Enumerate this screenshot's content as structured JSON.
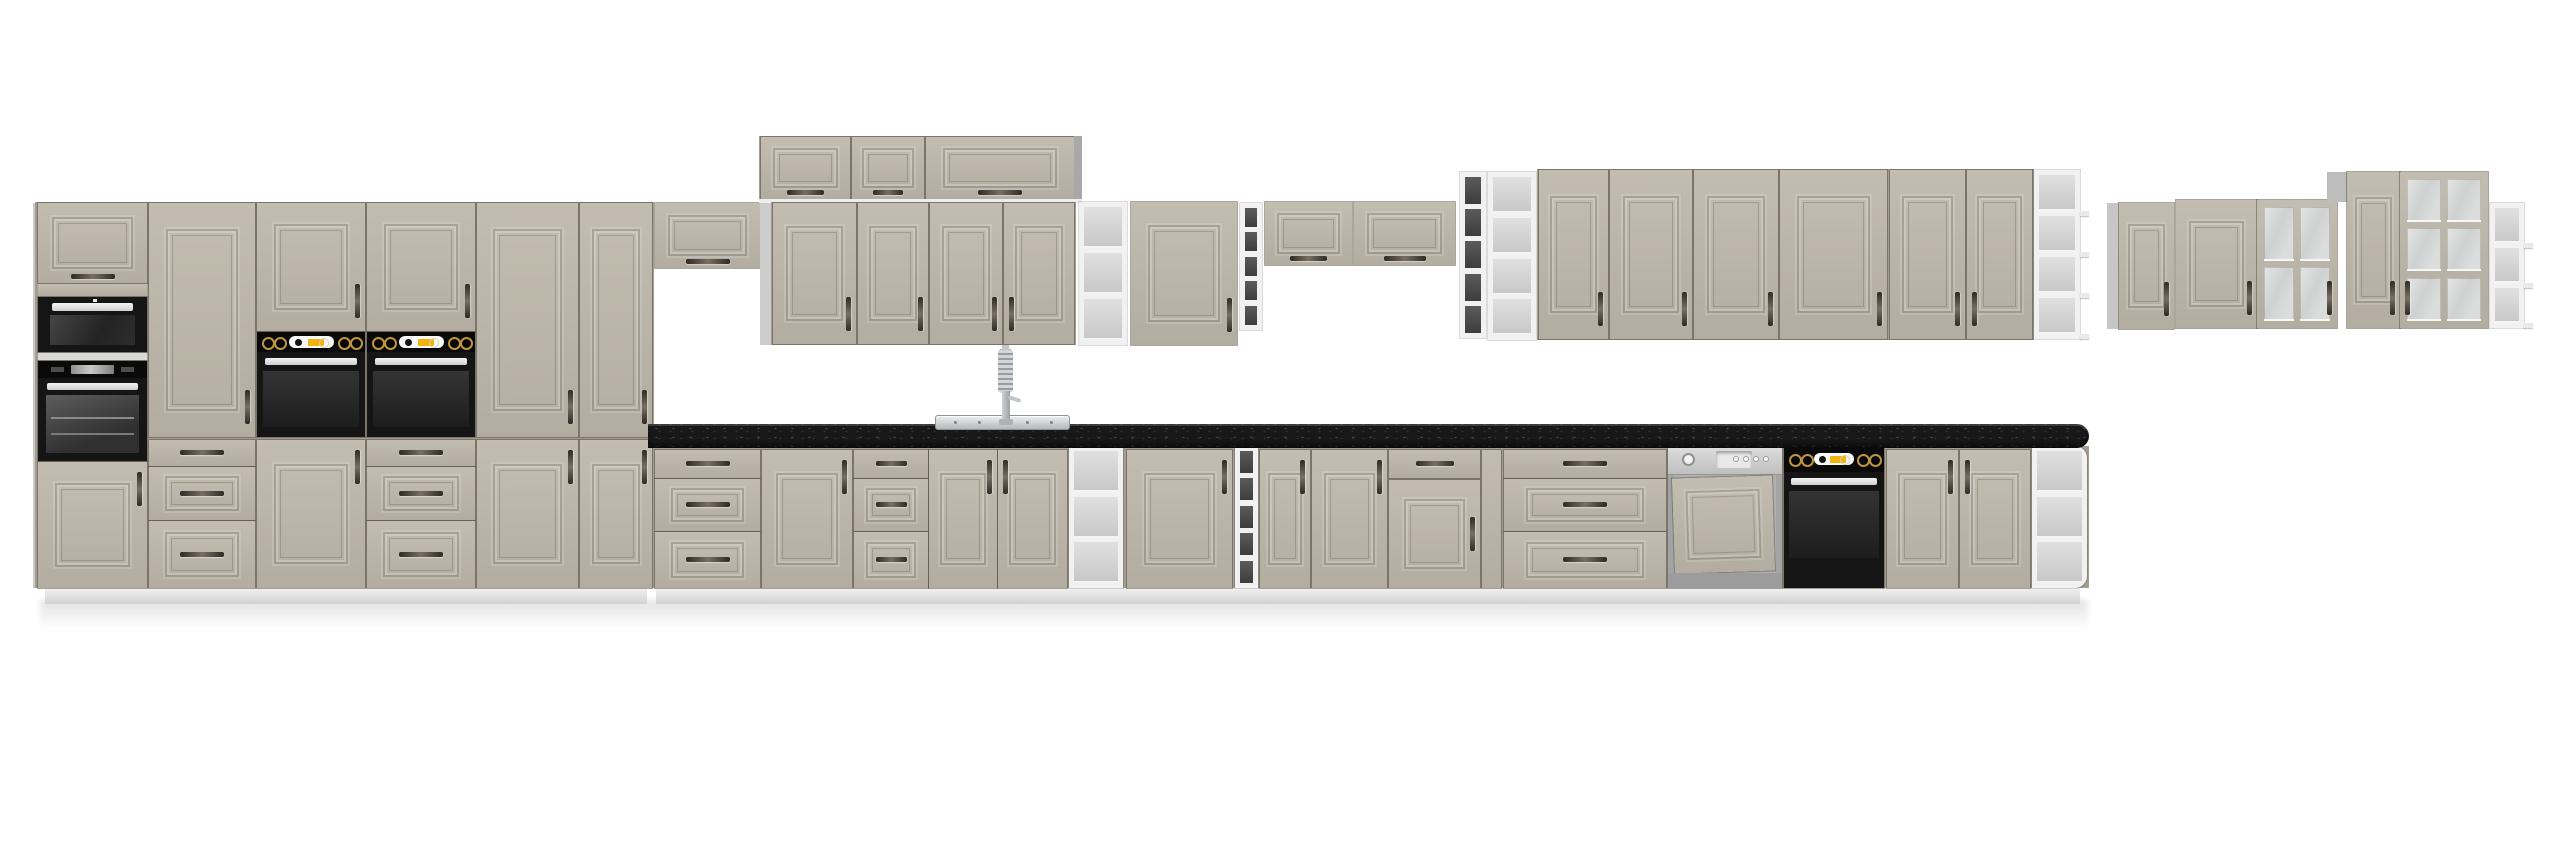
{
  "meta": {
    "domain": "product-render",
    "subject": "kitchen-cabinet-set"
  },
  "palette": {
    "front_beige": "#bcb7aa",
    "front_beige_dark": "#b2ada0",
    "carcass_grey": "#a29d90",
    "side_grey": "#c9c9c9",
    "white_trim": "#ededed",
    "counter_black": "#181818",
    "appliance_black": "#151515",
    "knob_gold": "#bf963f",
    "display_amber": "#f2b40c",
    "stainless": "#cfcfcf",
    "shelf_dark": "#484848",
    "shelf_light": "#d4d4d4",
    "plinth": "#e8e8e8",
    "background": "#ffffff",
    "handle_dark": "#3d3830"
  },
  "canvas": {
    "w": 2560,
    "h": 848
  },
  "scene": {
    "units": [
      {
        "t": "shadow",
        "x": 40,
        "y": 600,
        "w": 2048,
        "h": 30,
        "n": "floor-shadow"
      },
      {
        "t": "panel",
        "x": 33,
        "y": 203,
        "w": 5,
        "h": 385,
        "c": "#c9c9c9",
        "n": "tall-run-left-side"
      },
      {
        "t": "panel",
        "x": 35,
        "y": 202,
        "w": 619,
        "h": 386,
        "c": "#a29d90",
        "n": "tall-run-carcass"
      },
      {
        "t": "plinth",
        "x": 45,
        "y": 588,
        "w": 602,
        "h": 16,
        "n": "plinth"
      },
      {
        "t": "plinth",
        "x": 656,
        "y": 588,
        "w": 1424,
        "h": 16,
        "n": "plinth"
      },
      {
        "t": "panel",
        "x": 648,
        "y": 446,
        "w": 1441,
        "h": 142,
        "c": "#a29d90",
        "n": "base-run-carcass"
      },
      {
        "t": "flip",
        "x": 38,
        "y": 203,
        "w": 109,
        "h": 80,
        "hd": "bc",
        "n": "tall-flip-door"
      },
      {
        "t": "face",
        "x": 38,
        "y": 284,
        "w": 109,
        "h": 12,
        "n": "filler-face"
      },
      {
        "t": "microwave",
        "x": 38,
        "y": 297,
        "w": 109,
        "h": 55,
        "n": "built-in-microwave"
      },
      {
        "t": "panel",
        "x": 38,
        "y": 353,
        "w": 109,
        "h": 7,
        "c": "#d8d8d8",
        "n": "appliance-trim"
      },
      {
        "t": "ovenu1",
        "x": 38,
        "y": 361,
        "w": 109,
        "h": 100,
        "n": "built-in-oven"
      },
      {
        "t": "door",
        "x": 38,
        "y": 462,
        "w": 109,
        "h": 126,
        "hd": "tr",
        "n": "tall-lower-door"
      },
      {
        "t": "door",
        "x": 149,
        "y": 203,
        "w": 106,
        "h": 234,
        "hd": "br",
        "n": "tall-upper-door"
      },
      {
        "t": "drawer",
        "x": 149,
        "y": 440,
        "w": 106,
        "h": 26,
        "hd": "cc",
        "n": "drawer"
      },
      {
        "t": "drawer",
        "x": 149,
        "y": 467,
        "w": 106,
        "h": 53,
        "hd": "cc",
        "m": 1,
        "n": "drawer"
      },
      {
        "t": "drawer",
        "x": 149,
        "y": 521,
        "w": 106,
        "h": 67,
        "hd": "cc",
        "m": 1,
        "n": "drawer"
      },
      {
        "t": "door",
        "x": 257,
        "y": 203,
        "w": 108,
        "h": 128,
        "hd": "br",
        "n": "tall-upper-door"
      },
      {
        "t": "oven",
        "x": 257,
        "y": 332,
        "w": 108,
        "h": 105,
        "n": "built-in-oven"
      },
      {
        "t": "door",
        "x": 257,
        "y": 440,
        "w": 108,
        "h": 148,
        "hd": "tr",
        "n": "tall-lower-door"
      },
      {
        "t": "door",
        "x": 367,
        "y": 203,
        "w": 108,
        "h": 128,
        "hd": "br",
        "n": "tall-upper-door"
      },
      {
        "t": "oven",
        "x": 367,
        "y": 332,
        "w": 108,
        "h": 105,
        "n": "built-in-oven"
      },
      {
        "t": "drawer",
        "x": 367,
        "y": 440,
        "w": 108,
        "h": 26,
        "hd": "cc",
        "n": "drawer"
      },
      {
        "t": "drawer",
        "x": 367,
        "y": 467,
        "w": 108,
        "h": 53,
        "hd": "cc",
        "m": 1,
        "n": "drawer"
      },
      {
        "t": "drawer",
        "x": 367,
        "y": 521,
        "w": 108,
        "h": 67,
        "hd": "cc",
        "m": 1,
        "n": "drawer"
      },
      {
        "t": "door",
        "x": 477,
        "y": 203,
        "w": 101,
        "h": 234,
        "hd": "br",
        "n": "tall-upper-door"
      },
      {
        "t": "door",
        "x": 477,
        "y": 440,
        "w": 101,
        "h": 148,
        "hd": "tr",
        "n": "tall-lower-door"
      },
      {
        "t": "door",
        "x": 580,
        "y": 203,
        "w": 72,
        "h": 234,
        "hd": "br",
        "n": "tall-upper-door"
      },
      {
        "t": "door",
        "x": 580,
        "y": 440,
        "w": 72,
        "h": 148,
        "hd": "tr",
        "n": "tall-lower-door"
      },
      {
        "t": "flip",
        "x": 655,
        "y": 203,
        "w": 105,
        "h": 65,
        "hd": "bc",
        "n": "wall-flip-cabinet"
      },
      {
        "t": "panel",
        "x": 760,
        "y": 203,
        "w": 11,
        "h": 142,
        "c": "#cdcdcd",
        "n": "wall-side-filler"
      },
      {
        "t": "panel",
        "x": 759,
        "y": 136,
        "w": 322,
        "h": 65,
        "c": "#a29d90",
        "n": "topbox-carcass"
      },
      {
        "t": "flip",
        "x": 761,
        "y": 137,
        "w": 89,
        "h": 62,
        "hd": "bc",
        "n": "top-box-door"
      },
      {
        "t": "flip",
        "x": 852,
        "y": 137,
        "w": 72,
        "h": 62,
        "hd": "bc",
        "n": "top-box-door"
      },
      {
        "t": "flip",
        "x": 926,
        "y": 137,
        "w": 148,
        "h": 62,
        "hd": "bc",
        "n": "top-box-door"
      },
      {
        "t": "panel",
        "x": 1074,
        "y": 136,
        "w": 8,
        "h": 65,
        "c": "#a8a8a8",
        "n": "topbox-side"
      },
      {
        "t": "panel",
        "x": 759,
        "y": 199,
        "w": 323,
        "h": 4,
        "c": "#ededed",
        "n": "topbox-bottom-board"
      },
      {
        "t": "panel",
        "x": 771,
        "y": 202,
        "w": 305,
        "h": 143,
        "c": "#a29d90",
        "n": "wall-carcass"
      },
      {
        "t": "door",
        "x": 773,
        "y": 203,
        "w": 83,
        "h": 141,
        "hd": "br",
        "n": "wall-door"
      },
      {
        "t": "door",
        "x": 858,
        "y": 203,
        "w": 70,
        "h": 141,
        "hd": "br",
        "n": "wall-door"
      },
      {
        "t": "door",
        "x": 930,
        "y": 203,
        "w": 72,
        "h": 141,
        "hd": "br",
        "n": "wall-door"
      },
      {
        "t": "door",
        "x": 1004,
        "y": 203,
        "w": 70,
        "h": 141,
        "hd": "bl",
        "n": "wall-door"
      },
      {
        "t": "shelf",
        "x": 1079,
        "y": 202,
        "w": 48,
        "h": 143,
        "k": 3,
        "v": "light",
        "n": "wall-open-shelf"
      },
      {
        "t": "door",
        "x": 1131,
        "y": 202,
        "w": 106,
        "h": 143,
        "hd": "br",
        "n": "wall-door"
      },
      {
        "t": "shelf",
        "x": 1240,
        "y": 203,
        "w": 22,
        "h": 127,
        "k": 5,
        "v": "dark",
        "n": "wall-open-shelf"
      },
      {
        "t": "flip",
        "x": 1265,
        "y": 202,
        "w": 87,
        "h": 63,
        "hd": "bc",
        "n": "wall-flip-cabinet"
      },
      {
        "t": "flip",
        "x": 1354,
        "y": 202,
        "w": 101,
        "h": 63,
        "hd": "bc",
        "n": "wall-flip-cabinet"
      },
      {
        "t": "shelf",
        "x": 1460,
        "y": 172,
        "w": 26,
        "h": 166,
        "k": 5,
        "v": "dark",
        "n": "wall-open-shelf"
      },
      {
        "t": "shelf",
        "x": 1488,
        "y": 172,
        "w": 48,
        "h": 168,
        "k": 4,
        "v": "light",
        "n": "wall-open-shelf"
      },
      {
        "t": "panel",
        "x": 1537,
        "y": 169,
        "w": 497,
        "h": 171,
        "c": "#a29d90",
        "n": "wall-carcass"
      },
      {
        "t": "door",
        "x": 1539,
        "y": 170,
        "w": 69,
        "h": 169,
        "hd": "br",
        "n": "wall-door"
      },
      {
        "t": "door",
        "x": 1610,
        "y": 170,
        "w": 82,
        "h": 169,
        "hd": "br",
        "n": "wall-door"
      },
      {
        "t": "door",
        "x": 1694,
        "y": 170,
        "w": 84,
        "h": 169,
        "hd": "br",
        "n": "wall-door"
      },
      {
        "t": "door",
        "x": 1780,
        "y": 170,
        "w": 107,
        "h": 169,
        "hd": "br",
        "n": "wall-door"
      },
      {
        "t": "door",
        "x": 1890,
        "y": 170,
        "w": 75,
        "h": 169,
        "hd": "br",
        "n": "wall-door"
      },
      {
        "t": "door",
        "x": 1967,
        "y": 170,
        "w": 65,
        "h": 169,
        "hd": "bl",
        "n": "wall-door"
      },
      {
        "t": "shelf",
        "x": 2034,
        "y": 170,
        "w": 46,
        "h": 169,
        "k": 4,
        "v": "light",
        "lips": 1,
        "n": "wall-open-shelf-end"
      },
      {
        "t": "drawer",
        "x": 655,
        "y": 450,
        "w": 105,
        "h": 28,
        "hd": "cc",
        "n": "base-drawer"
      },
      {
        "t": "drawer",
        "x": 655,
        "y": 479,
        "w": 105,
        "h": 52,
        "hd": "cc",
        "m": 1,
        "n": "base-drawer"
      },
      {
        "t": "drawer",
        "x": 655,
        "y": 532,
        "w": 105,
        "h": 56,
        "hd": "cc",
        "m": 1,
        "n": "base-drawer"
      },
      {
        "t": "door",
        "x": 762,
        "y": 450,
        "w": 90,
        "h": 138,
        "hd": "tr",
        "n": "base-door"
      },
      {
        "t": "drawer",
        "x": 854,
        "y": 450,
        "w": 74,
        "h": 28,
        "hd": "cc",
        "n": "base-drawer"
      },
      {
        "t": "drawer",
        "x": 854,
        "y": 479,
        "w": 74,
        "h": 52,
        "hd": "cc",
        "m": 1,
        "n": "base-drawer"
      },
      {
        "t": "drawer",
        "x": 854,
        "y": 532,
        "w": 74,
        "h": 56,
        "hd": "cc",
        "m": 1,
        "n": "base-drawer"
      },
      {
        "t": "door",
        "x": 929,
        "y": 450,
        "w": 68,
        "h": 138,
        "hd": "tr",
        "n": "sink-base-door"
      },
      {
        "t": "door",
        "x": 998,
        "y": 450,
        "w": 69,
        "h": 138,
        "hd": "tl",
        "n": "sink-base-door"
      },
      {
        "t": "shelf",
        "x": 1069,
        "y": 446,
        "w": 54,
        "h": 142,
        "k": 3,
        "v": "light",
        "n": "base-open-shelf"
      },
      {
        "t": "door",
        "x": 1127,
        "y": 450,
        "w": 105,
        "h": 138,
        "hd": "tr",
        "n": "base-door"
      },
      {
        "t": "shelf",
        "x": 1235,
        "y": 446,
        "w": 23,
        "h": 142,
        "k": 5,
        "v": "dark",
        "n": "base-open-shelf"
      },
      {
        "t": "door",
        "x": 1260,
        "y": 450,
        "w": 50,
        "h": 138,
        "hd": "tr",
        "n": "base-door"
      },
      {
        "t": "door",
        "x": 1312,
        "y": 450,
        "w": 75,
        "h": 138,
        "hd": "tr",
        "n": "base-door"
      },
      {
        "t": "drawer",
        "x": 1389,
        "y": 450,
        "w": 91,
        "h": 28,
        "hd": "cc",
        "n": "base-drawer"
      },
      {
        "t": "door",
        "x": 1389,
        "y": 480,
        "w": 91,
        "h": 108,
        "hd": "r",
        "n": "base-door"
      },
      {
        "t": "door",
        "x": 1482,
        "y": 450,
        "w": 19,
        "h": 138,
        "hd": "none",
        "n": "filler-door"
      },
      {
        "t": "drawer",
        "x": 1504,
        "y": 450,
        "w": 162,
        "h": 28,
        "hd": "cc",
        "n": "base-drawer"
      },
      {
        "t": "drawer",
        "x": 1504,
        "y": 479,
        "w": 162,
        "h": 52,
        "hd": "cc",
        "m": 1,
        "n": "base-drawer"
      },
      {
        "t": "drawer",
        "x": 1504,
        "y": 532,
        "w": 162,
        "h": 56,
        "hd": "cc",
        "m": 1,
        "n": "base-drawer"
      },
      {
        "t": "dishwasher",
        "x": 1668,
        "y": 446,
        "w": 114,
        "h": 142,
        "n": "dishwasher"
      },
      {
        "t": "ovenbase",
        "x": 1784,
        "y": 446,
        "w": 100,
        "h": 142,
        "n": "built-under-oven"
      },
      {
        "t": "door",
        "x": 1887,
        "y": 450,
        "w": 71,
        "h": 138,
        "hd": "tr",
        "n": "base-door"
      },
      {
        "t": "door",
        "x": 1960,
        "y": 450,
        "w": 70,
        "h": 138,
        "hd": "tl",
        "n": "base-door"
      },
      {
        "t": "shelf",
        "x": 2032,
        "y": 446,
        "w": 55,
        "h": 142,
        "k": 3,
        "v": "light",
        "round": 1,
        "n": "base-open-shelf-end"
      },
      {
        "t": "counter",
        "x": 648,
        "y": 424,
        "w": 1441,
        "h": 24,
        "n": "countertop"
      },
      {
        "t": "sink",
        "x": 935,
        "y": 415,
        "w": 133,
        "h": 13,
        "n": "sink"
      },
      {
        "t": "faucet",
        "x": 993,
        "y": 349,
        "w": 30,
        "h": 76,
        "n": "faucet"
      },
      {
        "t": "panel",
        "x": 2107,
        "y": 203,
        "w": 12,
        "h": 126,
        "c": "#c6c6c6",
        "n": "side-panel"
      },
      {
        "t": "door",
        "x": 2119,
        "y": 203,
        "w": 55,
        "h": 126,
        "hd": "br",
        "n": "wall-door"
      },
      {
        "t": "door",
        "x": 2176,
        "y": 200,
        "w": 81,
        "h": 128,
        "hd": "br",
        "n": "wall-door"
      },
      {
        "t": "glass",
        "x": 2257,
        "y": 200,
        "w": 80,
        "h": 128,
        "gr": 2,
        "gc": 2,
        "hd": "br",
        "n": "glass-wall-cabinet"
      },
      {
        "t": "panel",
        "x": 2327,
        "y": 172,
        "w": 20,
        "h": 30,
        "c": "#bdbdbd",
        "n": "side-wedge"
      },
      {
        "t": "door",
        "x": 2347,
        "y": 172,
        "w": 53,
        "h": 156,
        "hd": "br",
        "n": "wall-door"
      },
      {
        "t": "glass",
        "x": 2400,
        "y": 172,
        "w": 88,
        "h": 156,
        "gr": 3,
        "gc": 2,
        "hd": "bl",
        "n": "glass-wall-cabinet"
      },
      {
        "t": "shelf",
        "x": 2490,
        "y": 203,
        "w": 34,
        "h": 125,
        "k": 3,
        "v": "light",
        "lips": 1,
        "n": "wall-open-shelf-end"
      }
    ]
  }
}
